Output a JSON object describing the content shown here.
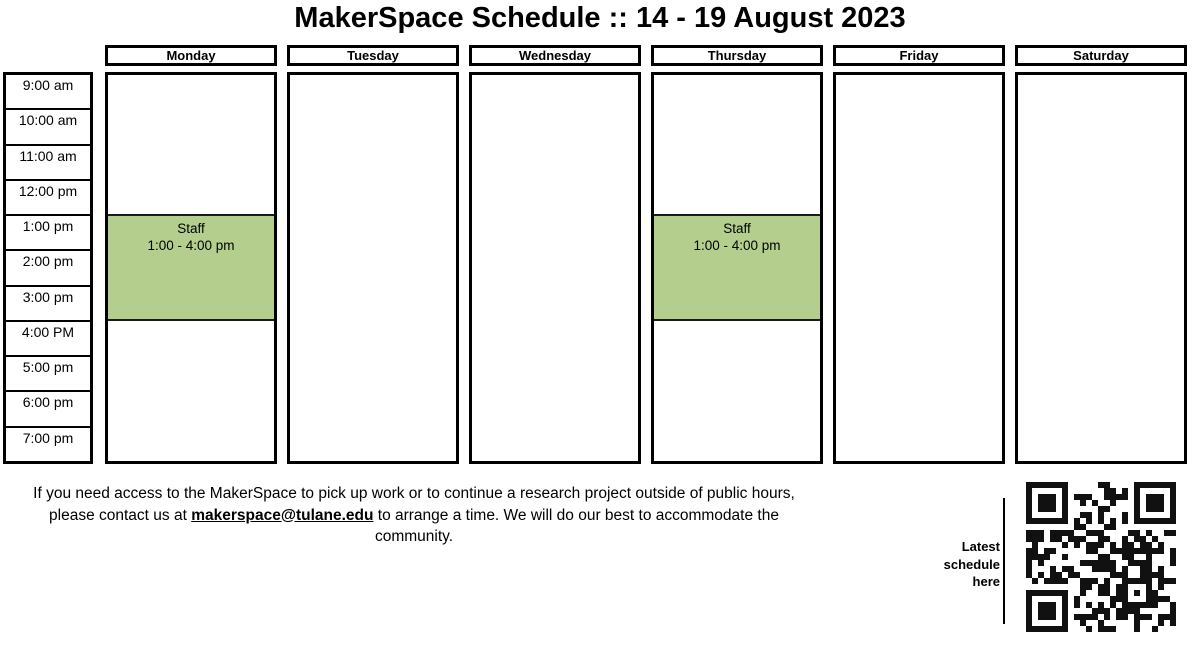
{
  "title": "MakerSpace Schedule :: 14 - 19 August 2023",
  "colors": {
    "event_fill": "#b4ce8e",
    "border": "#000000"
  },
  "schedule": {
    "days": [
      "Monday",
      "Tuesday",
      "Wednesday",
      "Thursday",
      "Friday",
      "Saturday"
    ],
    "times": [
      "9:00 am",
      "10:00 am",
      "11:00 am",
      "12:00 pm",
      "1:00 pm",
      "2:00 pm",
      "3:00 pm",
      "4:00 PM",
      "5:00 pm",
      "6:00 pm",
      "7:00 pm"
    ],
    "events": [
      {
        "day": "Monday",
        "title": "Staff",
        "time": "1:00 - 4:00 pm"
      },
      {
        "day": "Thursday",
        "title": "Staff",
        "time": "1:00 - 4:00 pm"
      }
    ]
  },
  "footer": {
    "line1": "If you need access to the MakerSpace to pick up work or to continue a research project outside of public hours,",
    "line2_before": "please contact us at ",
    "email": "makerspace@tulane.edu",
    "line2_after": " to arrange a time. We will do our best to accommodate the",
    "line3": "community."
  },
  "qr": {
    "label": "Latest schedule here"
  }
}
